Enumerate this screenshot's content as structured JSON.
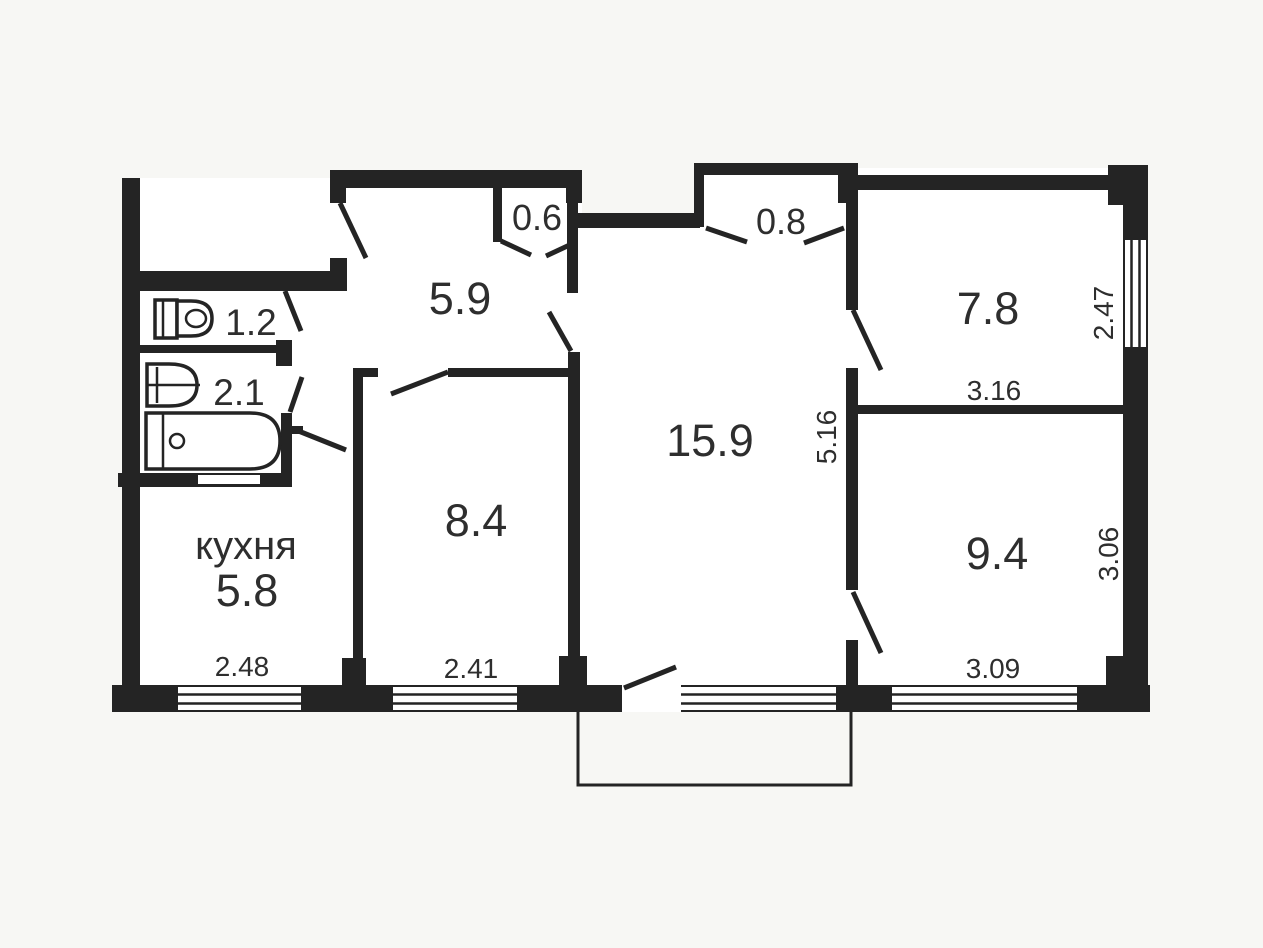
{
  "title": "apartment floor plan",
  "colors": {
    "background": "#f7f7f4",
    "room_fill": "#ffffff",
    "wall": "#242424",
    "label": "#2e2e2e"
  },
  "rooms": {
    "hallway": {
      "area": "5.9"
    },
    "closet_small": {
      "area": "0.6"
    },
    "closet_large": {
      "area": "0.8"
    },
    "toilet": {
      "area": "1.2"
    },
    "bathroom": {
      "area": "2.1"
    },
    "kitchen": {
      "name": "кухня",
      "area": "5.8",
      "width_m": "2.48"
    },
    "room_mid": {
      "area": "8.4",
      "width_m": "2.41"
    },
    "living_room": {
      "area": "15.9",
      "depth_m": "5.16"
    },
    "room_top_right": {
      "area": "7.8",
      "width_m": "3.16",
      "window_side_m": "2.47"
    },
    "room_bottom_right": {
      "area": "9.4",
      "width_m": "3.09",
      "side_m": "3.06"
    }
  }
}
